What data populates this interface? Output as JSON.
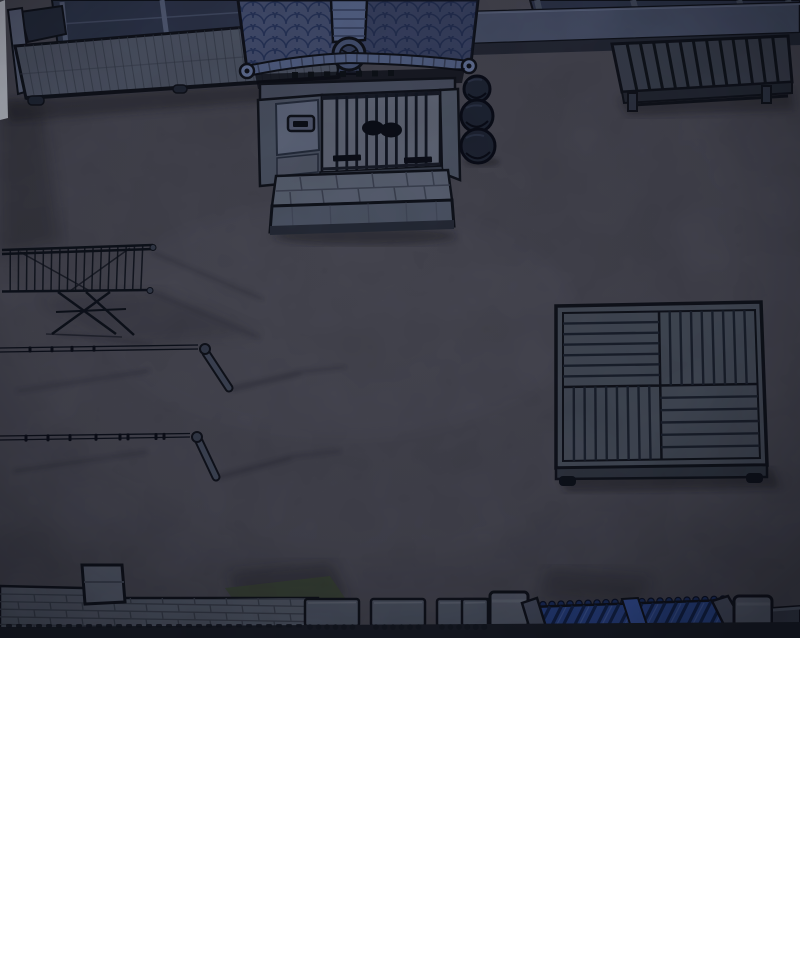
{
  "alt": "Overhead night view of a traditional Korean house courtyard: tiled entrance gate at top center, wooden porch with sliding windows at top left, stone ledge and slatted bench at top right, stacked jars beside the gate, a folding drying rack, two clothesline poles, a square slatted wooden platform, and a brick boundary wall with a blue tiled gate roof along the bottom.",
  "scene": {
    "objects": [
      "courtyard-ground",
      "porch-windows",
      "wooden-porch",
      "entrance-gate-roof",
      "gate-doors",
      "mail-slot",
      "stone-doorstep",
      "storage-jars",
      "stone-ledge",
      "slatted-bench",
      "folding-drying-rack",
      "clothesline-upper",
      "clothesline-lower",
      "wooden-platform",
      "brick-wall",
      "wall-pillar",
      "wall-capstones",
      "blue-gate-roof",
      "boundary-wall"
    ],
    "time_of_day": "night"
  },
  "palette": {
    "ink": "#12151f",
    "ground": "#4c4c58",
    "ground-light": "#76768a",
    "shadow": "#14161f",
    "roof-tile": "#4a5578",
    "roof-line": "#2c3a63",
    "roof-dark": "#1b2340",
    "roof-ridge": "#5e6d95",
    "roof-eave": "#5b6a92",
    "roof-eave-cap": "#6b7aa2",
    "wood": "#545b6d",
    "plank-line": "#39404f",
    "window-pane": "#313950",
    "window-frame": "#5a6480",
    "wall-face": "#525a6c",
    "wall-panel": "#677087",
    "mailbox": "#59617a",
    "door-face": "#6a7182",
    "door-bar": "#151a28",
    "lintel": "#4e5568",
    "step-top": "#636b7e",
    "step-front": "#555d70",
    "step-line": "#3f4657",
    "jar": "#222839",
    "ledge": "#4d5670",
    "ledge-base": "#272c3a",
    "bench-top": "#3e4453",
    "bench-front": "#272c38",
    "bench-gap": "#12161f",
    "platform-top": "#4b5260",
    "platform-gap": "#1e2432",
    "platform-front": "#343a47",
    "rack-line": "#10141f",
    "wire": "#0f131f",
    "pole": "#454c5e",
    "brick": "#596070",
    "brick-line": "#3e4452",
    "capstone": "#565d6e",
    "capstone-edge": "#6e7584",
    "pillar": "#5d6374",
    "pillar-top": "#6a7080",
    "fence-blue": "#2d4a94",
    "fence-rib": "#152650",
    "fence-blue-light": "#3a57a8",
    "fence-sheen": "#546fb6",
    "hedge": "#3f4a3a",
    "end-wall": "#3a404e",
    "bottom-band": "#1c202b",
    "highlight": "#d8dde8"
  }
}
